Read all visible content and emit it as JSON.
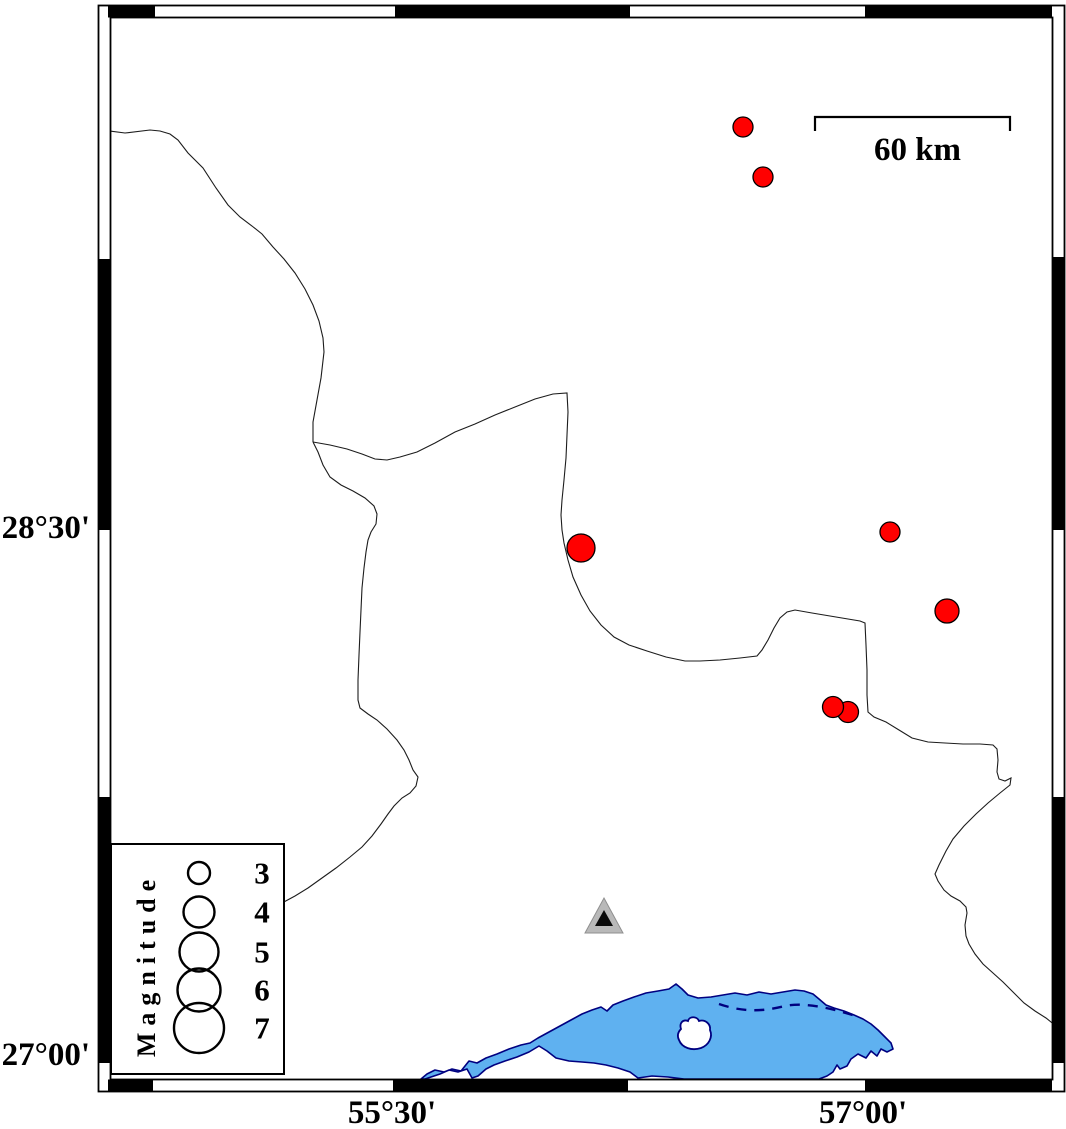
{
  "colors": {
    "epicenter": "#ff0000",
    "water": "#5fb1f0",
    "coast": "#000080",
    "boundary": "#1c1c1c",
    "station_outer": "#b9b9b9",
    "station_inner": "#0a0a0a",
    "frame": "#000000"
  },
  "axes": {
    "left_labels": [
      {
        "text": "28°30'",
        "y": 528
      },
      {
        "text": "27°00'",
        "y": 1055
      }
    ],
    "bottom_labels": [
      {
        "text": "55°30'",
        "x": 392
      },
      {
        "text": "57°00'",
        "x": 863
      }
    ]
  },
  "scale_bar": {
    "label": "60 km",
    "x1": 815,
    "x2": 1010,
    "y": 117
  },
  "legend": {
    "title": "Magnitude",
    "circle_cx": 87,
    "value_x": 150,
    "entries": [
      {
        "label": "3",
        "cy": 873,
        "r": 11
      },
      {
        "label": "4",
        "cy": 912,
        "r": 15.5
      },
      {
        "label": "5",
        "cy": 952,
        "r": 19.5
      },
      {
        "label": "6",
        "cy": 990,
        "r": 21.5
      },
      {
        "label": "7",
        "cy": 1028,
        "r": 25
      }
    ]
  },
  "earthquakes": [
    {
      "x": 743,
      "y": 127,
      "r": 10
    },
    {
      "x": 763,
      "y": 177,
      "r": 10
    },
    {
      "x": 581,
      "y": 548,
      "r": 14
    },
    {
      "x": 890,
      "y": 532,
      "r": 10
    },
    {
      "x": 947,
      "y": 611,
      "r": 12
    },
    {
      "x": 848,
      "y": 712,
      "r": 10.5
    },
    {
      "x": 833,
      "y": 707,
      "r": 10.5
    }
  ],
  "station": {
    "x": 604,
    "y": 919
  },
  "frame": {
    "top_segments_x": [
      [
        108,
        155
      ],
      [
        395,
        630
      ],
      [
        865,
        1052
      ]
    ],
    "bottom_segments_x": [
      [
        108,
        153
      ],
      [
        393,
        628
      ],
      [
        865,
        1052
      ]
    ],
    "left_segments_y": [
      [
        259,
        530
      ],
      [
        797,
        1063
      ]
    ],
    "right_segments_y": [
      [
        257,
        530
      ],
      [
        797,
        1063
      ]
    ]
  }
}
